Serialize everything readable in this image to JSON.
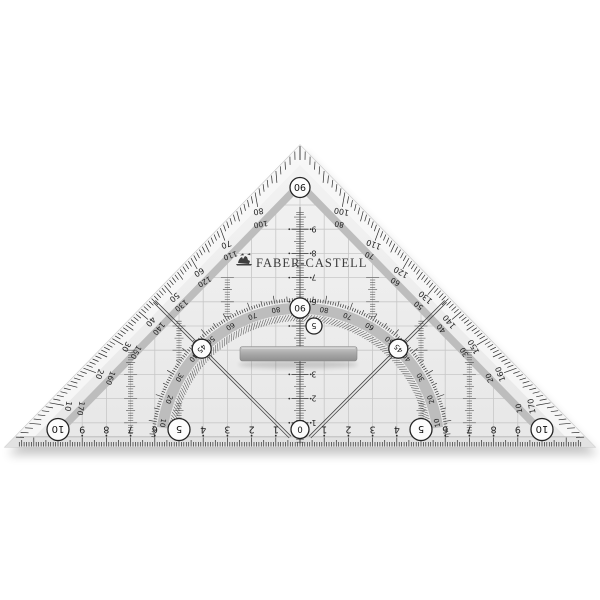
{
  "brand": {
    "name": "FABER-CASTELL",
    "emblem": "jousting-knights-icon"
  },
  "instrument": {
    "kind": "transparent geometry set square with protractor, grid and removable handle"
  },
  "apex_protractor_label": "90",
  "arc_protractor": {
    "top_label": "90",
    "diagonal_labels": [
      "45",
      "45"
    ],
    "left_scale": [
      10,
      20,
      30,
      40,
      50,
      60,
      70,
      80
    ],
    "right_scale": [
      10,
      20,
      30,
      40,
      50,
      60,
      70,
      80
    ]
  },
  "edge_scales": {
    "left_outer": [
      80,
      70,
      60,
      50,
      40,
      30,
      20,
      10
    ],
    "left_inner": [
      100,
      110,
      120,
      130,
      140,
      150,
      160,
      170
    ],
    "right_outer": [
      100,
      110,
      120,
      130,
      140,
      150,
      160,
      170
    ],
    "right_inner": [
      80,
      70,
      60,
      50,
      40,
      30,
      20,
      10
    ]
  },
  "bottom_ruler": {
    "unit": "cm",
    "left_numbers": [
      1,
      2,
      3,
      4,
      6,
      7,
      8,
      9
    ],
    "right_numbers": [
      1,
      2,
      3,
      4,
      6,
      7,
      8,
      9
    ],
    "circled": {
      "zero": "0",
      "five": "5",
      "ten": "10"
    },
    "unit_cm_px": 24.2,
    "half_length_cm": 10
  },
  "center_scale": {
    "numbers": [
      1,
      2,
      3,
      6,
      7,
      8,
      9
    ],
    "circled": "5"
  },
  "colors": {
    "background": "#ffffff",
    "body": "#ededed",
    "edge_strip": "#f8f8f8",
    "ruler_strip": "#e0e0e0",
    "band": "#bdbdbd",
    "grid": "#c7c7c7",
    "ink": "#2c2c2c",
    "handle": "#a5a5a5",
    "handle_light": "#cdcdcd",
    "handle_dark": "#8f8f8f",
    "circle_fill": "#fcfcfc",
    "shadow": "rgba(0,0,0,0.25)"
  }
}
